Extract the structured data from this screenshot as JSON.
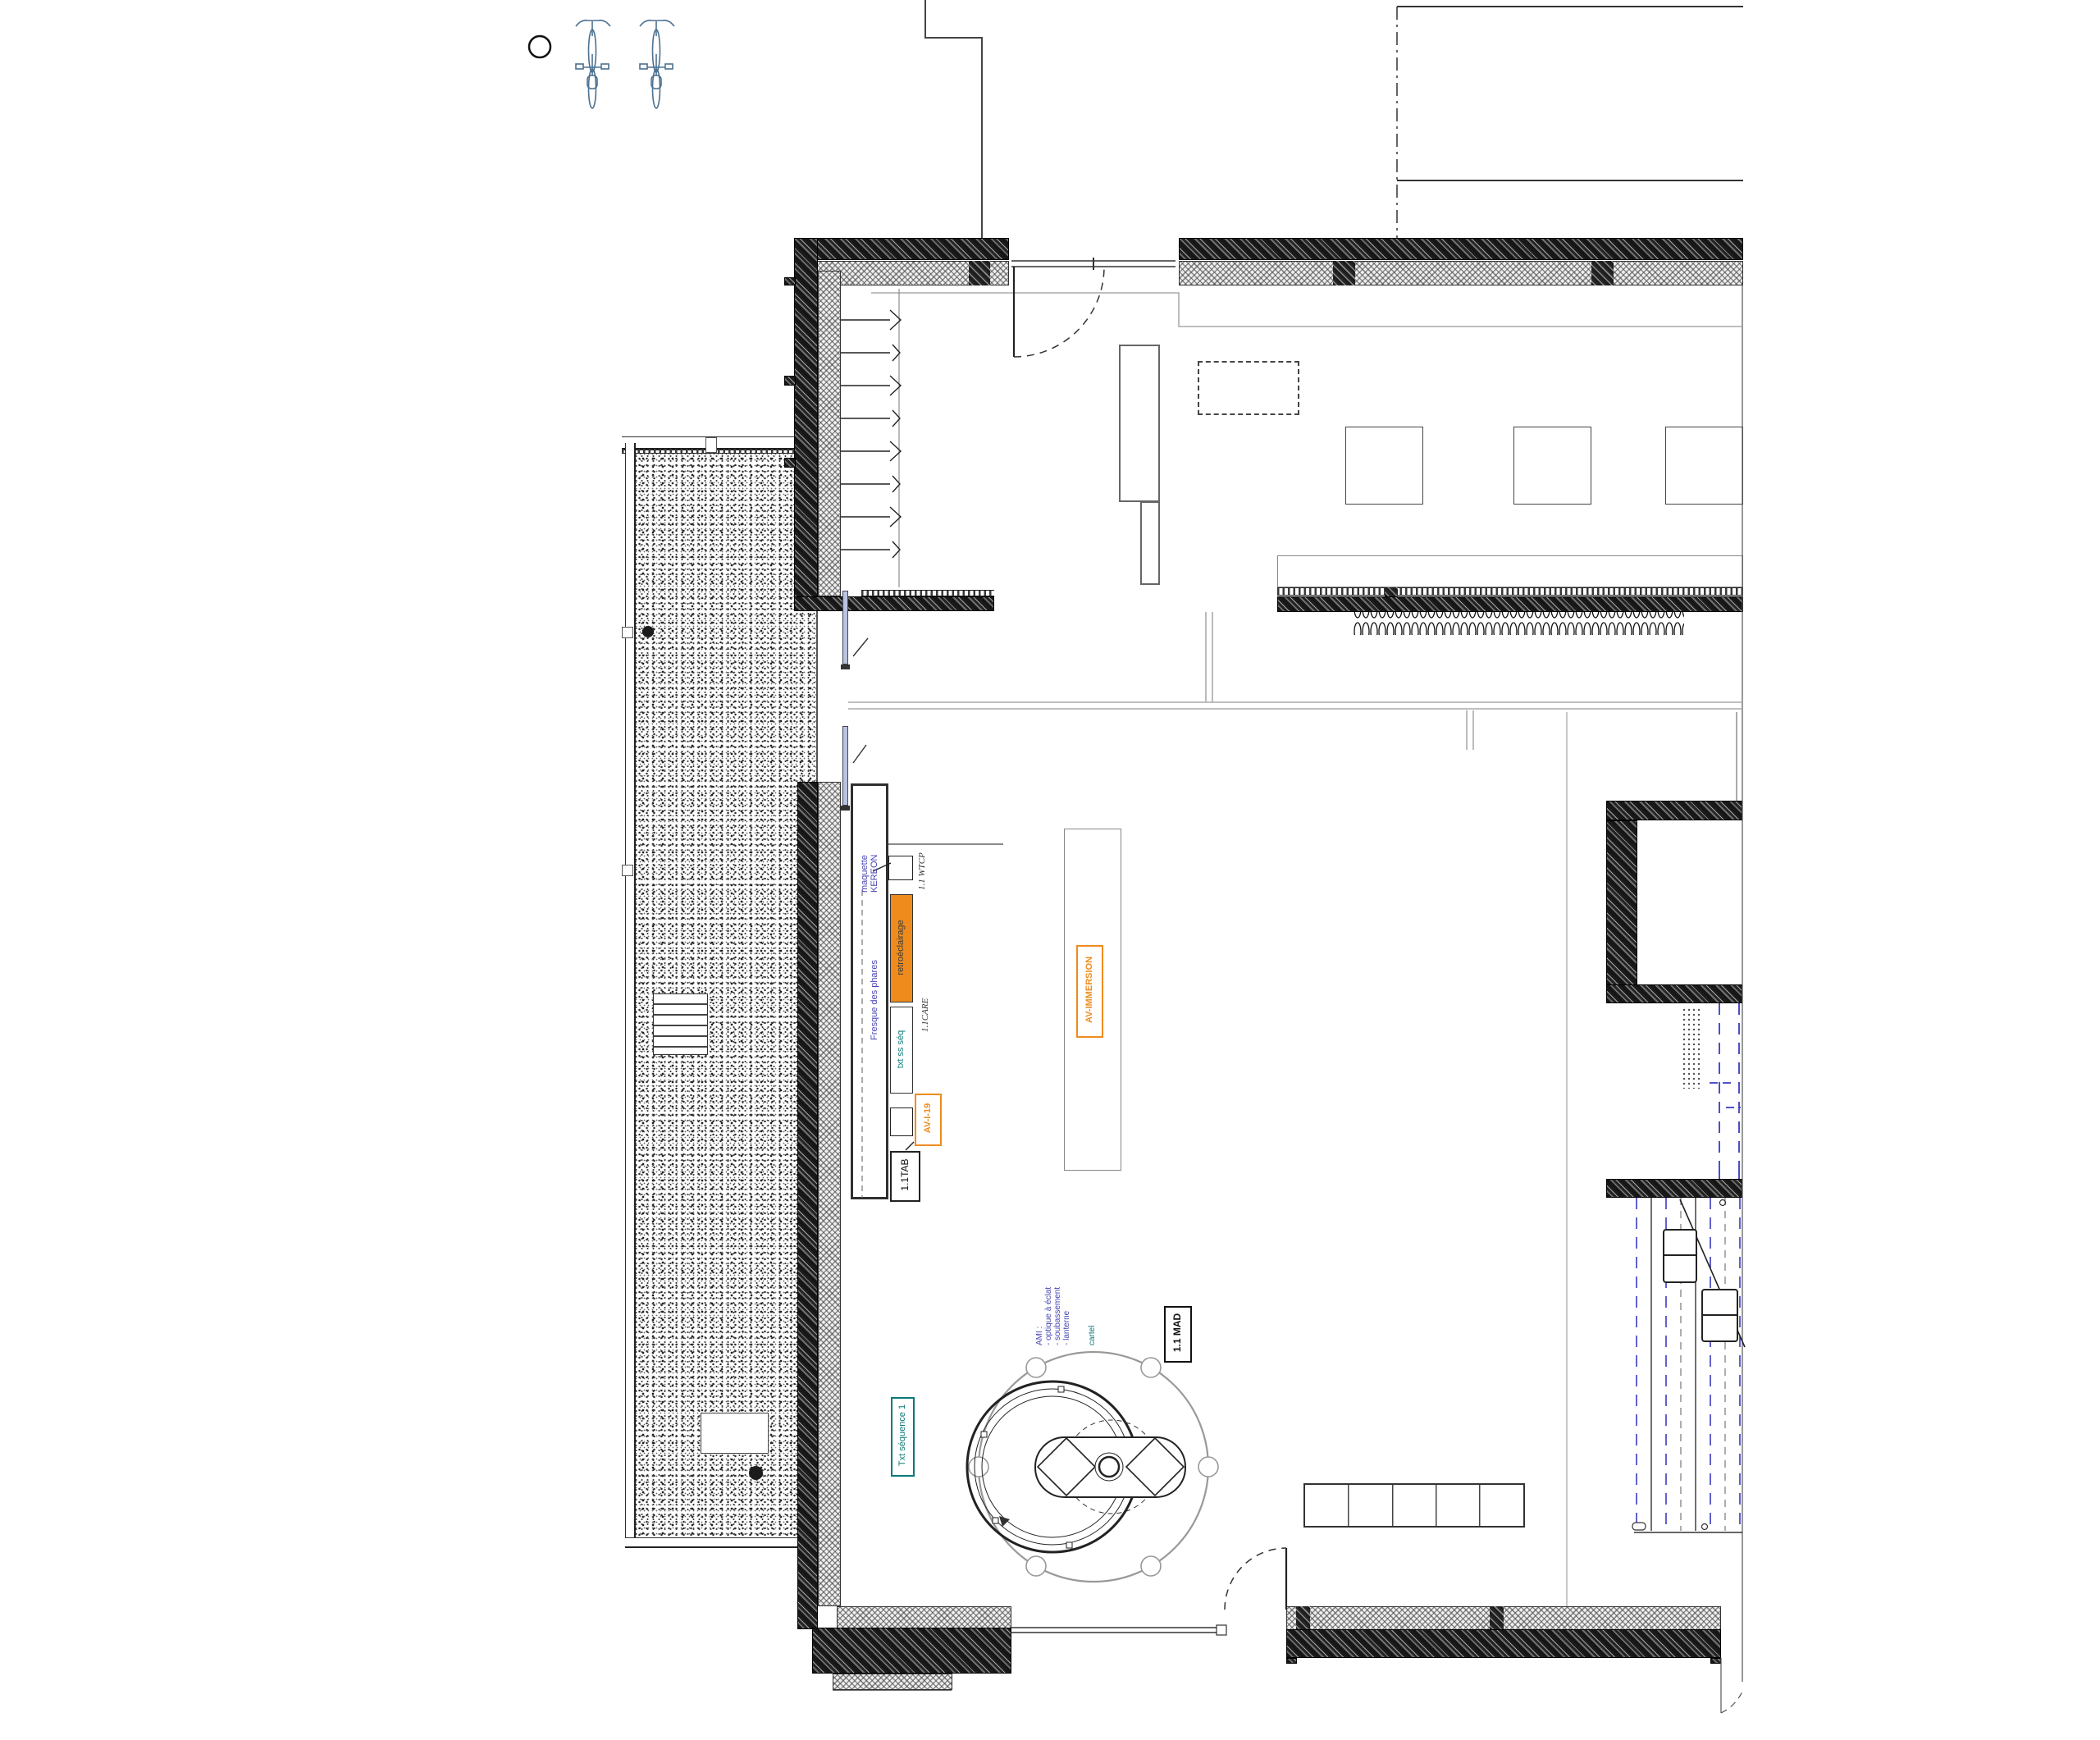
{
  "drawing": {
    "kind": "architectural floor plan, museum exhibition room (séquence 1)",
    "sheet_background": "#ffffff"
  },
  "colors": {
    "orange_accent": "#EF8B1D",
    "teal_accent": "#0C7A78",
    "blue_label": "#4545B2",
    "blue_dashed_line": "#3A3AC0",
    "bike_blue": "#4C7190",
    "wall_dark": "#2B2B2B",
    "thin_line_gray": "#999999",
    "glass_blue": "#B8C4E0"
  },
  "labels": {
    "maquette_line1": "maquette",
    "maquette_line2": "KEREON",
    "wtcp_code": "1.1 WTCP",
    "fresque_title": "Fresque des phares",
    "retroeclairage": "retroéclairage",
    "care_code": "1.1CARE",
    "txt_ss_seq": "txt ss séq",
    "avi19_code": "AV-I-19",
    "tab_code": "1.1TAB",
    "av_immersion": "AV-IMMERSION",
    "ami_line1": "AMI :",
    "ami_line2": "- optique à éclat",
    "ami_line3": "- soubassement",
    "ami_line4": "- lanterne",
    "cartel": "cartel",
    "mad_code": "1.1 MAD",
    "txt_sequence1": "Txt séquence 1"
  }
}
